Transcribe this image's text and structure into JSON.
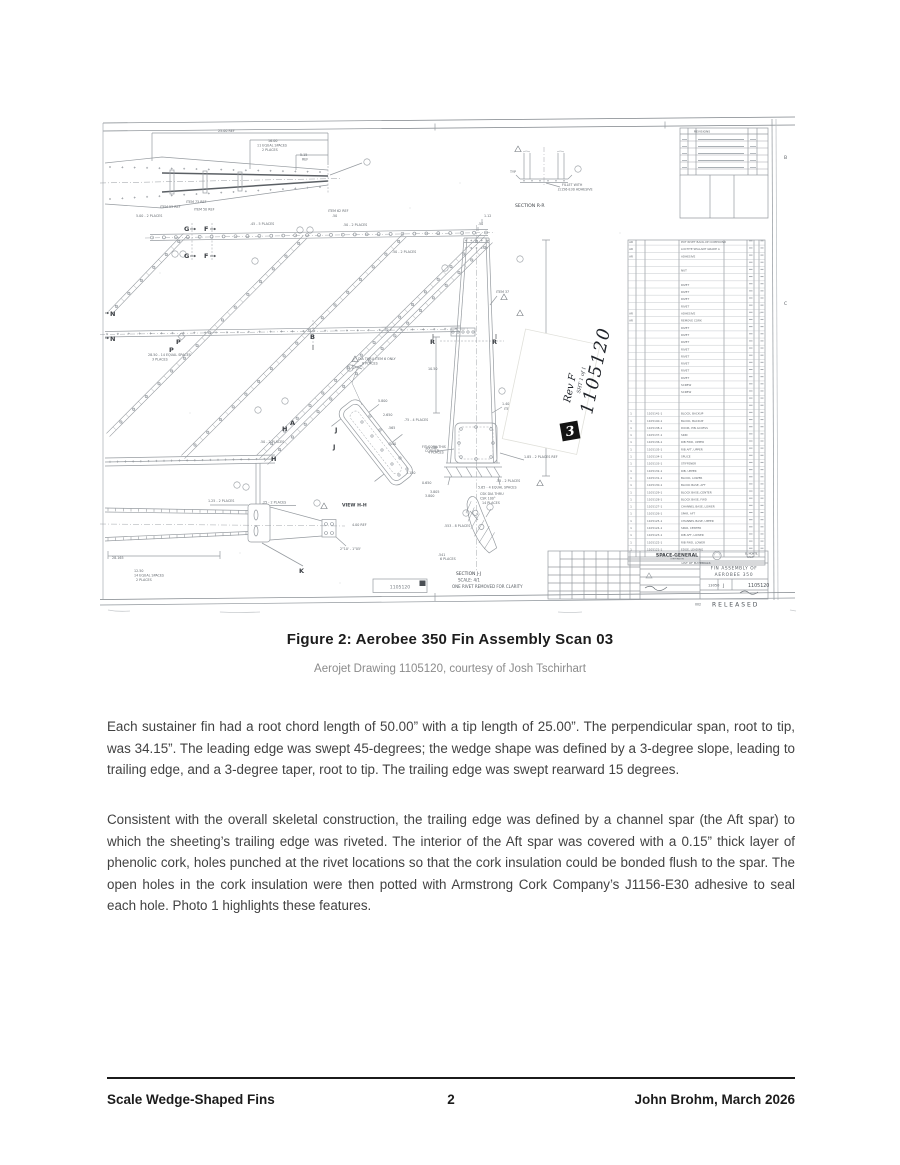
{
  "figure": {
    "caption": "Figure 2: Aerobee 350 Fin Assembly Scan 03",
    "credit": "Aerojet Drawing 1105120, courtesy of Josh Tschirhart"
  },
  "body": {
    "paragraph1": "Each sustainer fin had a root chord length of 50.00” with a tip length of 25.00”. The perpendicular span, root to tip, was 34.15”. The leading edge was swept 45-degrees; the wedge shape was defined by a 3-degree slope, leading to trailing edge, and a 3-degree taper, root to tip. The trailing edge was swept rearward 15 degrees.",
    "paragraph2": "Consistent with the overall skeletal construction, the trailing edge was defined by a channel spar (the Aft spar) to which the sheeting’s trailing edge was riveted. The interior of the Aft spar was covered with a 0.15” thick layer of phenolic cork, holes punched at the rivet locations so that the cork insulation could be bonded flush to the spar. The open holes in the cork insulation were then potted with Armstrong Cork Company’s J1156-E30 adhesive to seal each hole. Photo 1 highlights these features."
  },
  "footer": {
    "left": "Scale Wedge-Shaped Fins",
    "page_number": "2",
    "right": "John Brohm, March 2026"
  },
  "drawing": {
    "handwritten": {
      "number": "1105120",
      "rev": "Rev F",
      "sheet_note": "SHT 1 of 1",
      "revision_box": "3"
    },
    "stamp_box_number": "1105120",
    "revisions_title": "REVISIONS",
    "list_of_materials": "LIST OF MATERIALS",
    "zone_letters": {
      "b": "B",
      "c": "C"
    },
    "title_block": {
      "company": "SPACE-GENERAL",
      "company_sub": "CORPORATION",
      "location1": "EL MONTE,",
      "location2": "CALIF.",
      "title_line1": "FIN ASSEMBLY OF",
      "title_line2": "AEROBEE 350",
      "code": "13050",
      "size": "J",
      "drawing_number": "1105120",
      "released": "RELEASED",
      "released_prefix": "002"
    },
    "sections": {
      "section_rr": "SECTION R-R",
      "view_hh": "VIEW H-H",
      "section_jj": "SECTION J-J",
      "jj_scale": "SCALE: 4/1",
      "jj_note": "ONE RIVET REMOVED FOR CLARITY"
    },
    "cut_letters": {
      "g": "G",
      "f": "F",
      "n": "N",
      "p": "P",
      "b": "B",
      "r": "R",
      "h": "H",
      "j": "J",
      "k": "K",
      "a": "A"
    },
    "annotations": {
      "dim_2500": "25.00 REF",
      "dim_1600": "16.00",
      "dim_11eq": "11 EQUAL SPACES",
      "dim_2pl": "2 PLACES",
      "dim_515": "5.15",
      "ref": "REF",
      "dim_500_2pl": "5.00 - 2 PLACES",
      "item53": "ITEM 53 REF",
      "item73": "ITEM 73 REF",
      "item50": "ITEM 50 REF",
      "item62": "ITEM 62 REF",
      "dim_45_5pl": ".45 - 5 PLACES",
      "dim_50_2pl": ".50 - 2 PLACES",
      "dim_50": ".50",
      "dim_2850": "28.50 - 14 EQUAL SPACES",
      "pl3": "3 PLACES",
      "dia_item6": "DIA THRU ITEM 6 ONLY",
      "pl8": "8 PLACES",
      "dim_112": "1.12",
      "dim_1050": "10.50",
      "dim_3415": "34.15",
      "dim_140_2pl": "1.40 - 2 PLACES",
      "item32": "ITEM 32 REF",
      "item37": "ITEM 37",
      "dim_185": "1.85 - 2 PLACES REF",
      "gap81": ".81 GAP",
      "pl4": "4 PLACES",
      "dim_55_2pl": ".55 - 2 PLACES",
      "dim_565_4eq": "5.65 - 4 EQUAL SPACES",
      "dim_3805": "3.805",
      "csk1": "CSK DIA THRU",
      "csk2": "CSK 100°",
      "pl14": "14 PLACES",
      "dim_28165": "28.165",
      "dim_1250": "12.50",
      "eq14": "14 EQUAL SPACES",
      "dim_125_2pl": "1.25 - 2 PLACES",
      "dim_25_2pl": ".25 - 2 PLACES",
      "dim_400ref": "4.00 REF",
      "ang": "2°10' - 1°05'",
      "dim_5800": "5.800",
      "dim_2650": "2.650",
      "dim_565b": ".565",
      "dim_40": ".40",
      "dim_1150": "1.150",
      "dim_0650": "0.650",
      "dim_3800": "3.800",
      "dim_75_4pl": ".75 - 4 PLACES",
      "fit1": "FIT CORK THIS",
      "fit2": "CORNER",
      "dim_553_8pl": ".553 - 8 PLACES",
      "dim_541": ".541",
      "pl6": "6 PLACES",
      "typ": "TYP",
      "fillet1": "FILLET WITH",
      "fillet2": "J1156-E30 ADHESIVE"
    },
    "parts_list": [
      [
        "AR",
        "",
        "POT RIVET BACK-UP COMPOUND"
      ],
      [
        "AR",
        "",
        "LOCTITE SEALANT GRADE A"
      ],
      [
        "AR",
        "",
        "ADHESIVE"
      ],
      [
        "",
        "",
        ""
      ],
      [
        "",
        "",
        "NUT"
      ],
      [
        "",
        "",
        ""
      ],
      [
        "",
        "",
        "RIVET"
      ],
      [
        "",
        "",
        "RIVET"
      ],
      [
        "",
        "",
        "RIVET"
      ],
      [
        "",
        "",
        "RIVET"
      ],
      [
        "AR",
        "",
        "ADHESIVE"
      ],
      [
        "AR",
        "",
        "REMOVE CORK"
      ],
      [
        "",
        "",
        "RIVET"
      ],
      [
        "",
        "",
        "RIVET"
      ],
      [
        "",
        "",
        "RIVET"
      ],
      [
        "",
        "",
        "RIVET"
      ],
      [
        "",
        "",
        "RIVET"
      ],
      [
        "",
        "",
        "RIVET"
      ],
      [
        "",
        "",
        "RIVET"
      ],
      [
        "",
        "",
        "RIVET"
      ],
      [
        "",
        "",
        "SCREW"
      ],
      [
        "",
        "",
        "SCREW"
      ],
      [
        "",
        "",
        ""
      ],
      [
        "",
        "",
        ""
      ],
      [
        "1",
        "1105141-1",
        "BLOCK, BACKUP"
      ],
      [
        "1",
        "1105140-1",
        "BLOCK, BACKUP"
      ],
      [
        "1",
        "1105138-1",
        "DOOR, PIN ACCESS"
      ],
      [
        "1",
        "1105137-1",
        "SKIN"
      ],
      [
        "1",
        "1105136-1",
        "RIB FWD, UPPER"
      ],
      [
        "1",
        "1105135-1",
        "RIB AFT, UPPER"
      ],
      [
        "1",
        "1105134-1",
        "SPLICE"
      ],
      [
        "1",
        "1105133-1",
        "STIFFENER"
      ],
      [
        "1",
        "1105132-1",
        "RIB, UPPER"
      ],
      [
        "1",
        "1105131-1",
        "BLOCK, LOWER"
      ],
      [
        "1",
        "1105130-1",
        "BLOCK BASE, AFT"
      ],
      [
        "1",
        "1105129-1",
        "BLOCK BASE, CENTER"
      ],
      [
        "1",
        "1105128-1",
        "BLOCK BASE, FWD"
      ],
      [
        "1",
        "1105127-1",
        "CHANNEL BASE, LOWER"
      ],
      [
        "1",
        "1105126-1",
        "SPAR, AFT"
      ],
      [
        "1",
        "1105125-1",
        "CHANNEL BASE, UPPER"
      ],
      [
        "1",
        "1105124-1",
        "SPAR, CENTER"
      ],
      [
        "1",
        "1105123-1",
        "RIB AFT, LOWER"
      ],
      [
        "1",
        "1105122-1",
        "RIB FWD, LOWER"
      ],
      [
        "1",
        "1105121-1",
        "EDGE, LEADING"
      ]
    ]
  }
}
